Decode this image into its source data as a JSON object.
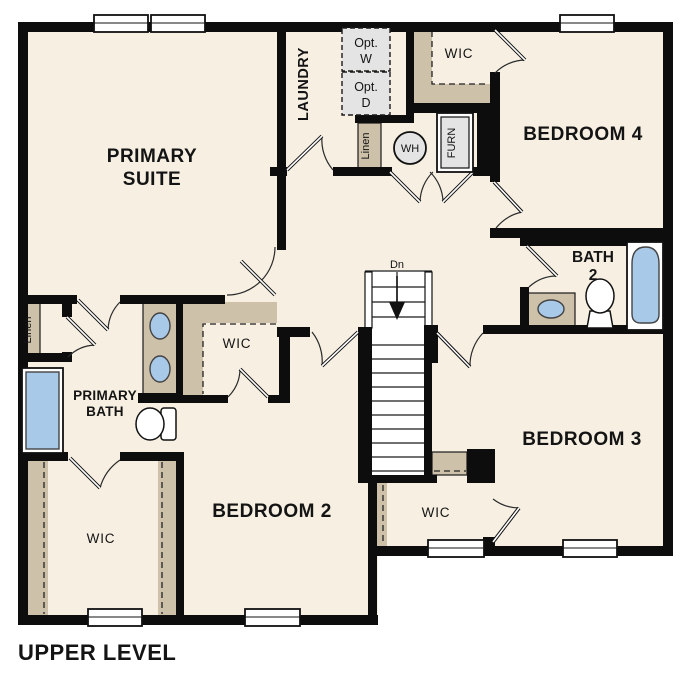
{
  "title": "UPPER LEVEL",
  "colors": {
    "floor": "#f6efe2",
    "wall": "#0d0d0d",
    "shelf_tan": "#cdc1a9",
    "fixture_blue": "#a9c9e9",
    "appliance_gray": "#e4e4e4"
  },
  "labels": {
    "primary_suite": [
      "PRIMARY",
      "SUITE"
    ],
    "laundry": "LAUNDRY",
    "opt_washer": [
      "Opt.",
      "W"
    ],
    "opt_dryer": [
      "Opt.",
      "D"
    ],
    "wic_bedroom4": "WIC",
    "bedroom4": "BEDROOM 4",
    "linen_hall": "Linen",
    "water_heater": "WH",
    "furnace": "FURN",
    "bath2": [
      "BATH",
      "2"
    ],
    "stairs_dn": "Dn",
    "primary_bath": [
      "PRIMARY",
      "BATH"
    ],
    "linen_primary": "Linen",
    "wic_primary": "WIC",
    "bedroom2": "BEDROOM 2",
    "wic_bedroom2": "WIC",
    "bedroom3": "BEDROOM 3",
    "wic_bedroom3": "WIC",
    "title": "UPPER LEVEL"
  }
}
